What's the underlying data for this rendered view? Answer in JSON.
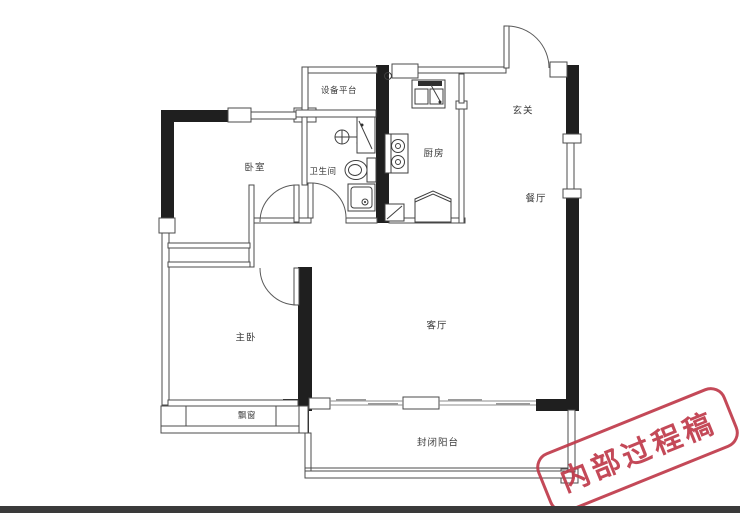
{
  "title": "两室户型平面图",
  "colors": {
    "background": "#ffffff",
    "wall": "#1f1f1f",
    "line": "#4b4b4b",
    "label": "#3a3a3a",
    "stamp": "#bf3a4a",
    "bottom_bar": "#3a3a3a"
  },
  "rooms": [
    {
      "id": "bedroom",
      "label": "卧室"
    },
    {
      "id": "equipment-platform",
      "label": "设备平台"
    },
    {
      "id": "bathroom",
      "label": "卫生间"
    },
    {
      "id": "kitchen",
      "label": "厨房"
    },
    {
      "id": "foyer",
      "label": "玄关"
    },
    {
      "id": "dining",
      "label": "餐厅"
    },
    {
      "id": "living",
      "label": "客厅"
    },
    {
      "id": "master-bedroom",
      "label": "主卧"
    },
    {
      "id": "bay-window",
      "label": "飘窗"
    },
    {
      "id": "balcony",
      "label": "封闭阳台"
    }
  ],
  "stamp": {
    "text": "内部过程稿"
  },
  "fixtures": {
    "bathroom": [
      "shower-icon",
      "vanity-cabinet-icon",
      "toilet-icon",
      "washbasin-icon"
    ],
    "kitchen": [
      "floor-drain-icon",
      "double-sink-icon",
      "stove-icon",
      "refrigerator-icon",
      "door-mat-icon"
    ],
    "doors": [
      "entry-door",
      "bedroom-door",
      "bathroom-door",
      "master-bedroom-door"
    ]
  }
}
